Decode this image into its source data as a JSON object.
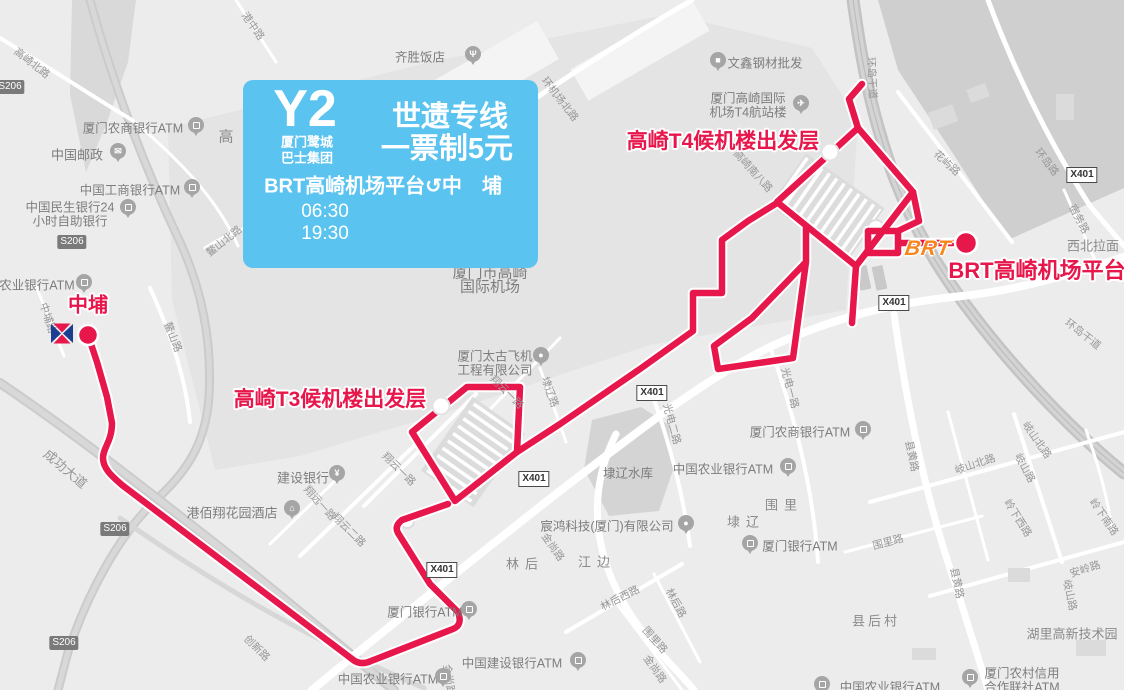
{
  "card": {
    "line_code": "Y2",
    "operator_line1": "厦门鹭城",
    "operator_line2": "巴士集团",
    "line_name": "世遗专线",
    "fare": "一票制5元",
    "route_desc": "BRT高崎机场平台↺中　埔",
    "first_bus": "06:30",
    "last_bus": "19:30"
  },
  "colors": {
    "route_red": "#e7164b",
    "card_blue": "#5bc3ef",
    "brt_orange": "#f6871f",
    "metro_blue": "#1b3e91",
    "label_gray": "#8a8a8a"
  },
  "map": {
    "brt_logo": {
      "t": "BRT",
      "x": 928,
      "y": 249
    },
    "stop_labels": [
      {
        "t": "中埔",
        "x": 88,
        "y": 303,
        "s": 20
      },
      {
        "t": "高崎T3候机楼出发层",
        "x": 330,
        "y": 398,
        "s": 21
      },
      {
        "t": "高崎T4候机楼出发层",
        "x": 723,
        "y": 140,
        "s": 21
      },
      {
        "t": "BRT高崎机场平台",
        "x": 1037,
        "y": 269,
        "s": 22
      }
    ],
    "pois": [
      {
        "lines": [
          "齐胜饭店"
        ],
        "x": 420,
        "y": 56,
        "pin": "restaurant",
        "px": 473,
        "py": 54
      },
      {
        "lines": [
          "文鑫钢材批发"
        ],
        "x": 765,
        "y": 62,
        "pin": "shop",
        "px": 718,
        "py": 60
      },
      {
        "lines": [
          "厦门高崎国际",
          "机场T4航站楼"
        ],
        "x": 748,
        "y": 97,
        "pin": "plane",
        "px": 801,
        "py": 103
      },
      {
        "lines": [
          "厦门市高崎",
          "国际机场"
        ],
        "x": 490,
        "y": 272,
        "s": 15
      },
      {
        "lines": [
          "厦门太古飞机",
          "工程有限公司"
        ],
        "x": 495,
        "y": 355,
        "pin": "generic",
        "px": 541,
        "py": 355
      },
      {
        "lines": [
          "建设银行"
        ],
        "x": 303,
        "y": 477,
        "s": 13,
        "pin": "bank",
        "px": 337,
        "py": 473
      },
      {
        "lines": [
          "港佰翔花园酒店"
        ],
        "x": 232,
        "y": 512,
        "s": 13,
        "pin": "hotel",
        "px": 292,
        "py": 508
      },
      {
        "lines": [
          "中国邮政"
        ],
        "x": 77,
        "y": 154,
        "s": 13,
        "pin": "post",
        "px": 118,
        "py": 151
      },
      {
        "lines": [
          "厦门农商银行ATM"
        ],
        "x": 133,
        "y": 127,
        "pin": "atm",
        "px": 196,
        "py": 125
      },
      {
        "lines": [
          "中国工商银行ATM"
        ],
        "x": 130,
        "y": 189,
        "pin": "atm",
        "px": 192,
        "py": 187
      },
      {
        "lines": [
          "中国民生银行24",
          "小时自助银行"
        ],
        "x": 70,
        "y": 206,
        "pin": "atm",
        "px": 128,
        "py": 207
      },
      {
        "lines": [
          "农业银行ATM"
        ],
        "x": 37,
        "y": 284,
        "pin": "atm",
        "px": 84,
        "py": 282
      },
      {
        "lines": [
          "埭辽水库"
        ],
        "x": 628,
        "y": 472
      },
      {
        "lines": [
          "中国农业银行ATM"
        ],
        "x": 723,
        "y": 468,
        "pin": "atm",
        "px": 788,
        "py": 466
      },
      {
        "lines": [
          "厦门农商银行ATM"
        ],
        "x": 800,
        "y": 431,
        "pin": "atm",
        "px": 863,
        "py": 429
      },
      {
        "lines": [
          "厦门银行ATM"
        ],
        "x": 800,
        "y": 545,
        "pin": "atm",
        "px": 750,
        "py": 543
      },
      {
        "lines": [
          "宸鸿科技(厦门)有限公司"
        ],
        "x": 607,
        "y": 525,
        "pin": "generic",
        "px": 686,
        "py": 523
      },
      {
        "lines": [
          "厦门银行ATM"
        ],
        "x": 425,
        "y": 611,
        "pin": "atm",
        "px": 469,
        "py": 609
      },
      {
        "lines": [
          "中国建设银行ATM"
        ],
        "x": 512,
        "y": 662,
        "pin": "atm",
        "px": 578,
        "py": 660
      },
      {
        "lines": [
          "中国农业银行ATM"
        ],
        "x": 388,
        "y": 678,
        "pin": "atm",
        "px": 443,
        "py": 676
      },
      {
        "lines": [
          "中国农业银行ATM"
        ],
        "x": 890,
        "y": 686,
        "pin": "atm",
        "px": 822,
        "py": 684
      },
      {
        "lines": [
          "厦门农村信用",
          "合作联社ATM"
        ],
        "x": 1022,
        "y": 672,
        "pin": "atm",
        "px": 970,
        "py": 677
      }
    ],
    "places": [
      {
        "t": "围里",
        "x": 784,
        "y": 504,
        "ls": 6
      },
      {
        "t": "埭辽",
        "x": 746,
        "y": 521,
        "ls": 6
      },
      {
        "t": "林后",
        "x": 525,
        "y": 563,
        "ls": 6
      },
      {
        "t": "江边",
        "x": 597,
        "y": 561,
        "ls": 6
      },
      {
        "t": "县后村",
        "x": 876,
        "y": 620,
        "ls": 3
      },
      {
        "t": "湖里高新技术园",
        "x": 1072,
        "y": 633
      },
      {
        "t": "高",
        "x": 226,
        "y": 136,
        "s": 15
      },
      {
        "t": "西北拉面",
        "x": 1093,
        "y": 245
      }
    ],
    "road_labels": [
      {
        "t": "高崎北路",
        "x": 32,
        "y": 63,
        "r": 38
      },
      {
        "t": "成功大道",
        "x": 66,
        "y": 468,
        "r": 40,
        "s": 13
      },
      {
        "t": "中埔路",
        "x": 48,
        "y": 318,
        "r": 72
      },
      {
        "t": "鳌山路",
        "x": 173,
        "y": 337,
        "r": 68
      },
      {
        "t": "鳌山北路",
        "x": 224,
        "y": 241,
        "r": -38
      },
      {
        "t": "创新路",
        "x": 257,
        "y": 648,
        "r": 45
      },
      {
        "t": "港中路",
        "x": 253,
        "y": 26,
        "r": 55
      },
      {
        "t": "环机场北路",
        "x": 560,
        "y": 99,
        "r": 52
      },
      {
        "t": "高崎南八路",
        "x": 753,
        "y": 171,
        "r": 48
      },
      {
        "t": "环岛干道",
        "x": 872,
        "y": 78,
        "r": 87
      },
      {
        "t": "环岛干道",
        "x": 1083,
        "y": 334,
        "r": 38
      },
      {
        "t": "环岛路",
        "x": 1047,
        "y": 162,
        "r": 52
      },
      {
        "t": "花屿路",
        "x": 947,
        "y": 163,
        "r": 42
      },
      {
        "t": "翔云一路",
        "x": 399,
        "y": 469,
        "r": 45
      },
      {
        "t": "翔云一路",
        "x": 507,
        "y": 392,
        "r": 45
      },
      {
        "t": "翔云二路",
        "x": 349,
        "y": 530,
        "r": 45
      },
      {
        "t": "翔远一路",
        "x": 320,
        "y": 503,
        "r": 48
      },
      {
        "t": "埭辽路",
        "x": 550,
        "y": 392,
        "r": 70
      },
      {
        "t": "金尚路",
        "x": 553,
        "y": 547,
        "r": 55
      },
      {
        "t": "金尚路",
        "x": 655,
        "y": 669,
        "r": 55
      },
      {
        "t": "金尚路",
        "x": 449,
        "y": 680,
        "r": 82
      },
      {
        "t": "光电一路",
        "x": 790,
        "y": 388,
        "r": 75
      },
      {
        "t": "光电二路",
        "x": 672,
        "y": 424,
        "r": 75
      },
      {
        "t": "县黄路",
        "x": 912,
        "y": 456,
        "r": 78
      },
      {
        "t": "县黄路",
        "x": 957,
        "y": 583,
        "r": 78
      },
      {
        "t": "岐山北路",
        "x": 975,
        "y": 464,
        "r": -18
      },
      {
        "t": "岐山北路",
        "x": 1037,
        "y": 440,
        "r": 55
      },
      {
        "t": "岐山路",
        "x": 1025,
        "y": 468,
        "r": 62
      },
      {
        "t": "岐山路",
        "x": 1070,
        "y": 595,
        "r": 78
      },
      {
        "t": "岭下西路",
        "x": 1018,
        "y": 518,
        "r": 58
      },
      {
        "t": "岭下南路",
        "x": 1104,
        "y": 517,
        "r": 55
      },
      {
        "t": "安岭路",
        "x": 1085,
        "y": 569,
        "r": -18
      },
      {
        "t": "围里路",
        "x": 888,
        "y": 542,
        "r": -15
      },
      {
        "t": "围里路",
        "x": 655,
        "y": 640,
        "r": 48
      },
      {
        "t": "林后西路",
        "x": 620,
        "y": 598,
        "r": -27
      },
      {
        "t": "林后路",
        "x": 676,
        "y": 603,
        "r": 62
      },
      {
        "t": "宿务路",
        "x": 1079,
        "y": 219,
        "r": 62
      }
    ],
    "badges": [
      {
        "t": "X401",
        "x": 534,
        "y": 479,
        "k": "x"
      },
      {
        "t": "X401",
        "x": 442,
        "y": 570,
        "k": "x"
      },
      {
        "t": "X401",
        "x": 652,
        "y": 393,
        "k": "x"
      },
      {
        "t": "X401",
        "x": 894,
        "y": 303,
        "k": "x"
      },
      {
        "t": "X401",
        "x": 1082,
        "y": 175,
        "k": "x"
      },
      {
        "t": "S206",
        "x": 10,
        "y": 87,
        "k": "s"
      },
      {
        "t": "S206",
        "x": 72,
        "y": 242,
        "k": "s"
      },
      {
        "t": "S206",
        "x": 115,
        "y": 529,
        "k": "s"
      },
      {
        "t": "S206",
        "x": 64,
        "y": 643,
        "k": "s"
      }
    ]
  }
}
